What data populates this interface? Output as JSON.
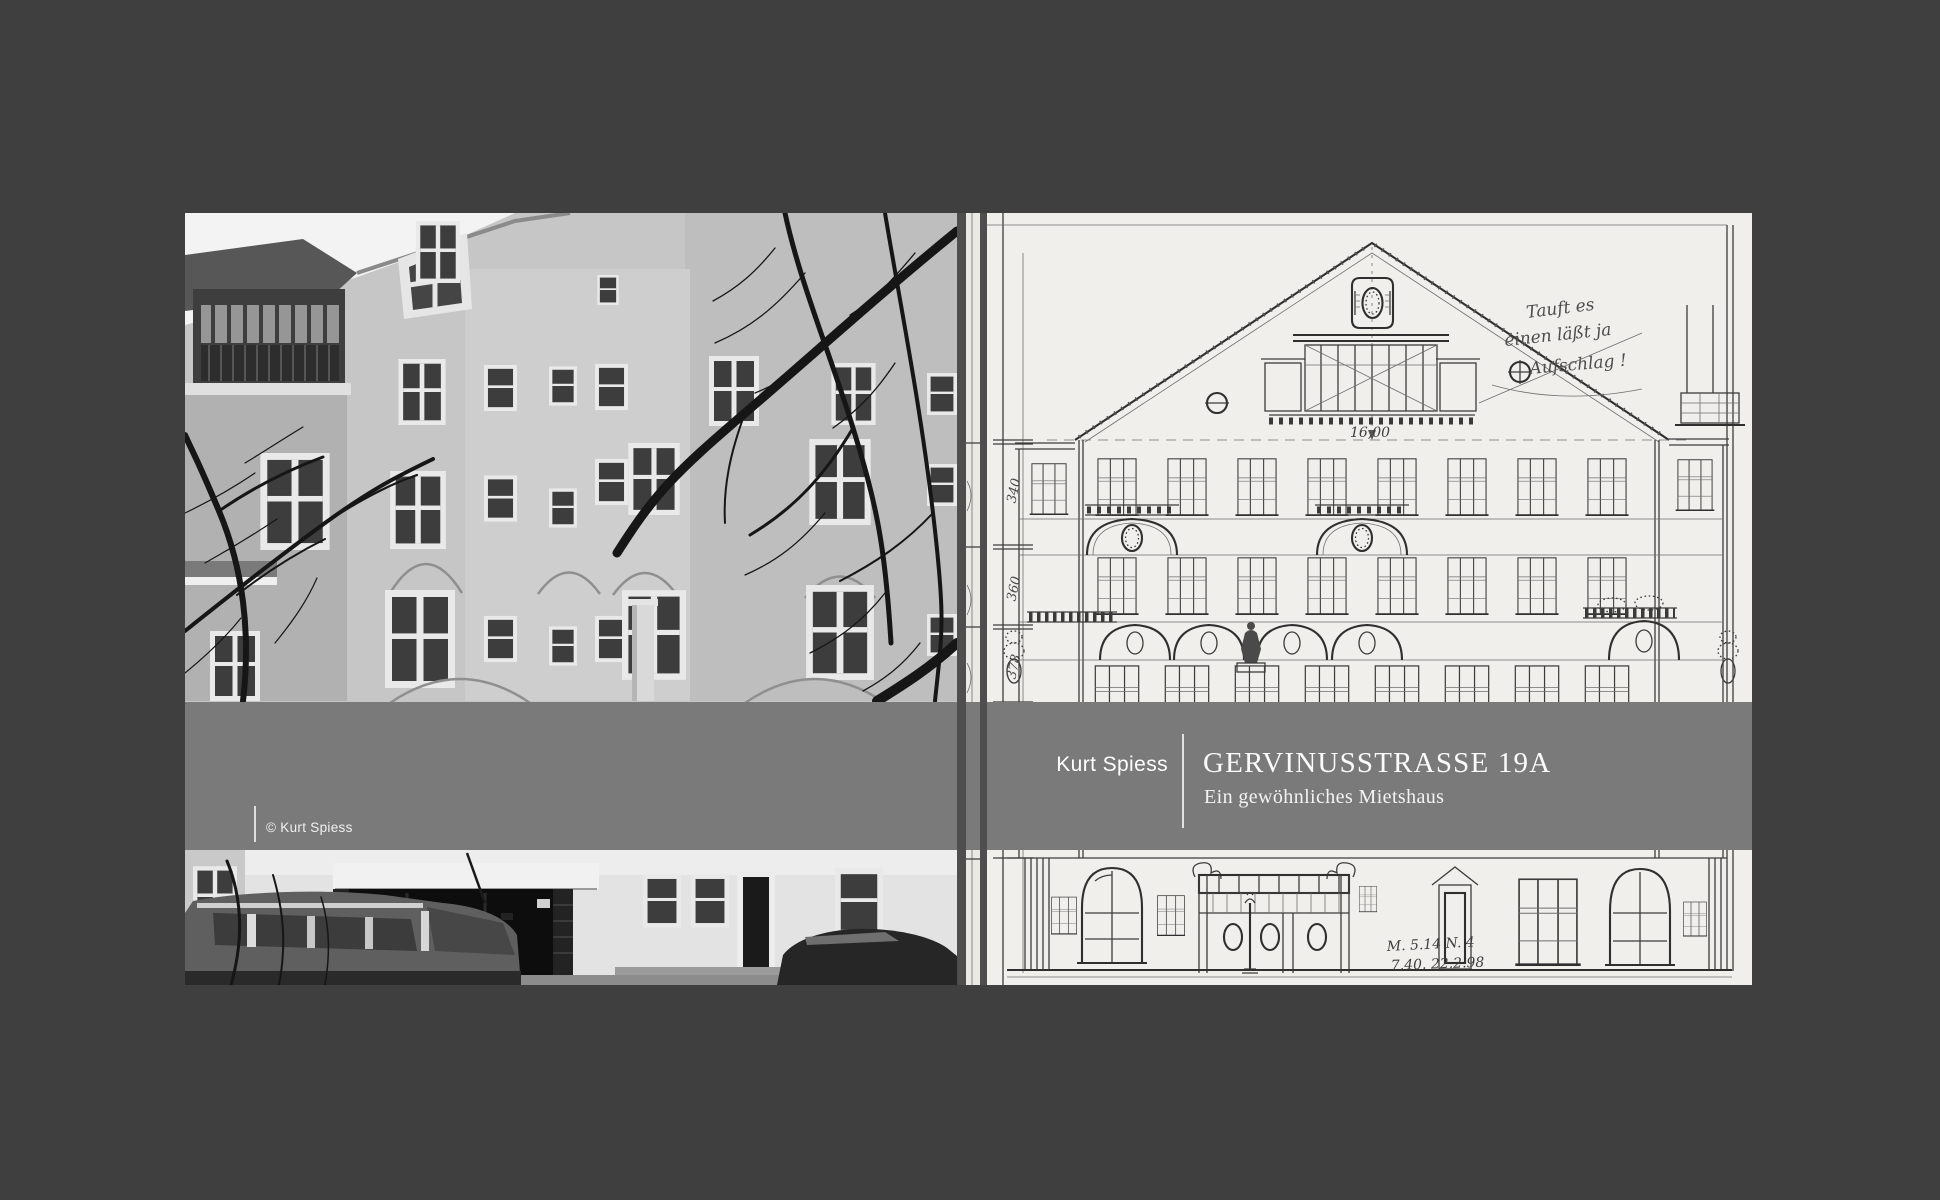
{
  "colors": {
    "background": "#3f3f40",
    "band": "#7a7a7a",
    "gutter_bar": "#4e4e4e",
    "drawing_paper": "#f0efeb",
    "text": "#ffffff"
  },
  "band": {
    "author": "Kurt Spiess",
    "title": "GERVINUSSTRASSE 19A",
    "subtitle": "Ein gewöhnliches Mietshaus"
  },
  "photo": {
    "credit": "© Kurt Spiess",
    "description": "Black-and-white photograph of the street facade of the apartment house, upper floors with windows and bare tree branches above, ground floor with entrance gate, house number plaque and parked cars below"
  },
  "drawing": {
    "description": "Pencil elevation drawing of the facade with centre gable, oval cartouches, arched bays, statue, entrance portal and dimension chains",
    "annotations": {
      "total_width": "16,00",
      "margin_dimensions": [
        "340",
        "360",
        "378"
      ],
      "note_lines": [
        "Tauft es",
        "einen läßt ja",
        "Aufschlag !"
      ],
      "date_lines": [
        "M. 5.14  N. 4",
        "7.40. 22.2.98"
      ]
    }
  }
}
